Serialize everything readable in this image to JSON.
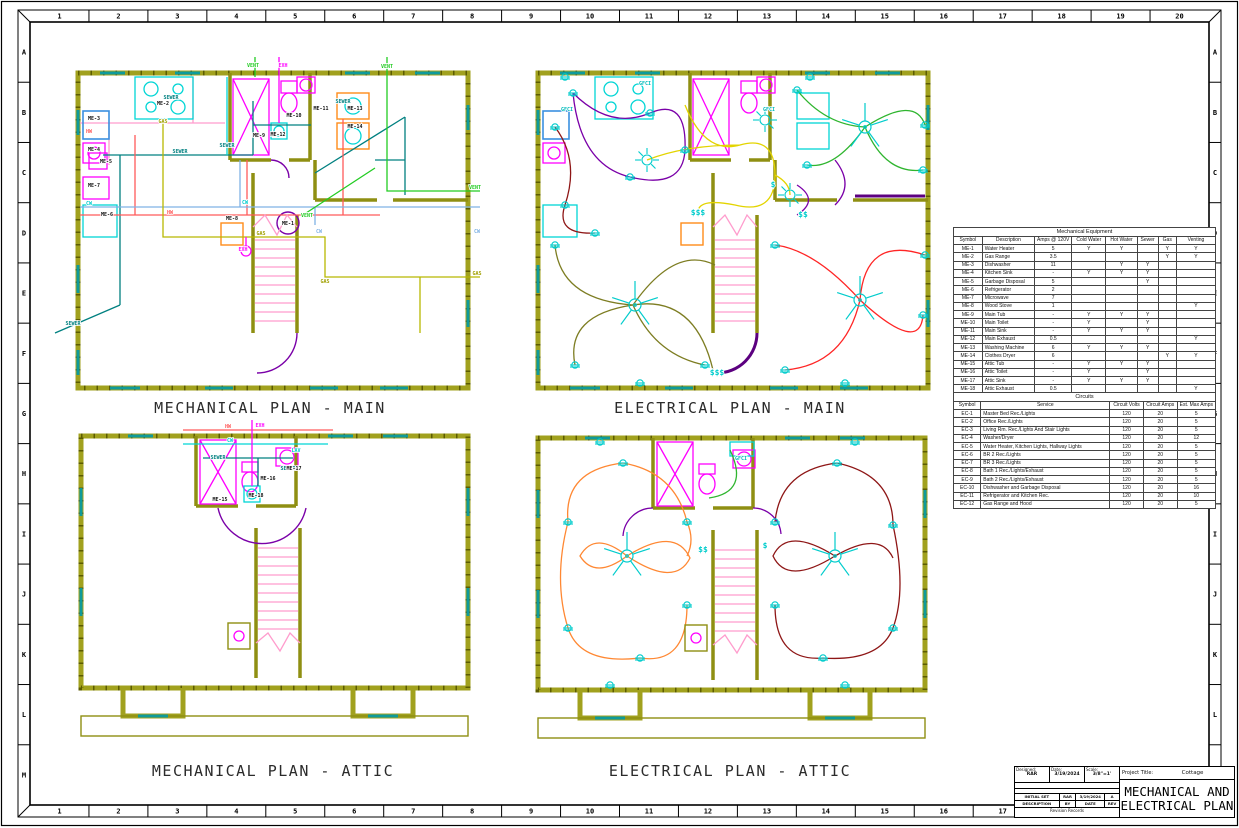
{
  "sheet": {
    "columns": [
      "1",
      "2",
      "3",
      "4",
      "5",
      "6",
      "7",
      "8",
      "9",
      "10",
      "11",
      "12",
      "13",
      "14",
      "15",
      "16",
      "17",
      "18",
      "19",
      "20"
    ],
    "rows": [
      "A",
      "B",
      "C",
      "D",
      "E",
      "F",
      "G",
      "H",
      "I",
      "J",
      "K",
      "L",
      "M"
    ]
  },
  "colors": {
    "wall": "#a1a11e",
    "sewer": "#008080",
    "hot_water": "#ff5a5a",
    "cold_water": "#7fb2e5",
    "gas": "#b8b800",
    "vent": "#22cc22",
    "exhaust": "#ff00ff",
    "fixture_magenta": "#ff00ff",
    "fixture_cyan": "#00d5d5",
    "circuit_yellow": "#e3d400",
    "circuit_red": "#ff2525",
    "circuit_green": "#2fb52f",
    "circuit_orange": "#ff8833",
    "circuit_dark_red": "#8e1616",
    "circuit_olive": "#7d7d22",
    "circuit_purple": "#7a00a8"
  },
  "plans": {
    "mech_main": {
      "title": "MECHANICAL PLAN - MAIN",
      "labels": [
        {
          "t": "VENT",
          "x": 178,
          "y": 2,
          "c": "#22cc22"
        },
        {
          "t": "EXH",
          "x": 208,
          "y": 2,
          "c": "#ff00ff"
        },
        {
          "t": "VENT",
          "x": 312,
          "y": 3,
          "c": "#22cc22"
        },
        {
          "t": "SEWER",
          "x": 96,
          "y": 34,
          "c": "#008080"
        },
        {
          "t": "SEWER",
          "x": 268,
          "y": 38,
          "c": "#008080"
        },
        {
          "t": "ME-2",
          "x": 88,
          "y": 40,
          "c": "#111111"
        },
        {
          "t": "GAS",
          "x": 88,
          "y": 58,
          "c": "#a0a000"
        },
        {
          "t": "ME-3",
          "x": 19,
          "y": 55,
          "c": "#111111"
        },
        {
          "t": "HW",
          "x": 14,
          "y": 68,
          "c": "#ff5a5a"
        },
        {
          "t": "ME-9",
          "x": 184,
          "y": 72,
          "c": "#111111"
        },
        {
          "t": "ME-10",
          "x": 219,
          "y": 52,
          "c": "#111111"
        },
        {
          "t": "ME-11",
          "x": 246,
          "y": 45,
          "c": "#111111"
        },
        {
          "t": "ME-12",
          "x": 203,
          "y": 71,
          "c": "#111111"
        },
        {
          "t": "ME-13",
          "x": 280,
          "y": 45,
          "c": "#111111"
        },
        {
          "t": "ME-14",
          "x": 280,
          "y": 63,
          "c": "#111111"
        },
        {
          "t": "ME-4",
          "x": 19,
          "y": 86,
          "c": "#111111"
        },
        {
          "t": "ME-5",
          "x": 31,
          "y": 98,
          "c": "#111111"
        },
        {
          "t": "SEWER",
          "x": 105,
          "y": 88,
          "c": "#008080"
        },
        {
          "t": "SEWER",
          "x": 152,
          "y": 82,
          "c": "#008080"
        },
        {
          "t": "ME-7",
          "x": 19,
          "y": 122,
          "c": "#111111"
        },
        {
          "t": "CW",
          "x": 14,
          "y": 140,
          "c": "#00cccc"
        },
        {
          "t": "ME-6",
          "x": 32,
          "y": 151,
          "c": "#111111"
        },
        {
          "t": "HW",
          "x": 95,
          "y": 149,
          "c": "#ff5a5a"
        },
        {
          "t": "ME-8",
          "x": 157,
          "y": 155,
          "c": "#111111"
        },
        {
          "t": "ME-1",
          "x": 213,
          "y": 160,
          "c": "#111111"
        },
        {
          "t": "CW",
          "x": 170,
          "y": 139,
          "c": "#00cccc"
        },
        {
          "t": "VENT",
          "x": 232,
          "y": 152,
          "c": "#22cc22"
        },
        {
          "t": "GAS",
          "x": 186,
          "y": 170,
          "c": "#a0a000"
        },
        {
          "t": "EXH",
          "x": 168,
          "y": 186,
          "c": "#ff00ff"
        },
        {
          "t": "CW",
          "x": 244,
          "y": 168,
          "c": "#7fb2e5"
        },
        {
          "t": "VENT",
          "x": 400,
          "y": 124,
          "c": "#22cc22"
        },
        {
          "t": "CW",
          "x": 402,
          "y": 168,
          "c": "#7fb2e5"
        },
        {
          "t": "GAS",
          "x": 402,
          "y": 210,
          "c": "#a0a000"
        },
        {
          "t": "GAS",
          "x": 250,
          "y": 218,
          "c": "#a0a000"
        },
        {
          "t": "SEWER",
          "x": -2,
          "y": 260,
          "c": "#008080"
        }
      ]
    },
    "elec_main": {
      "title": "ELECTRICAL PLAN - MAIN",
      "labels": [
        {
          "t": "GFCI",
          "x": 32,
          "y": 46,
          "c": "#00bbbb"
        },
        {
          "t": "GFCI",
          "x": 110,
          "y": 20,
          "c": "#00bbbb"
        },
        {
          "t": "GFCI",
          "x": 234,
          "y": 46,
          "c": "#00bbbb"
        },
        {
          "t": "$$$",
          "x": 163,
          "y": 150,
          "c": "#00cccc",
          "s": 8
        },
        {
          "t": "$$$",
          "x": 182,
          "y": 310,
          "c": "#00cccc",
          "s": 8
        },
        {
          "t": "$$",
          "x": 268,
          "y": 152,
          "c": "#00cccc",
          "s": 8
        },
        {
          "t": "$",
          "x": 238,
          "y": 122,
          "c": "#00cccc",
          "s": 8
        }
      ]
    },
    "mech_attic": {
      "title": "MECHANICAL PLAN - ATTIC",
      "labels": [
        {
          "t": "EXH",
          "x": 182,
          "y": -1,
          "c": "#ff00ff"
        },
        {
          "t": "HW",
          "x": 150,
          "y": 0,
          "c": "#ff5a5a"
        },
        {
          "t": "CW",
          "x": 152,
          "y": 14,
          "c": "#00cccc"
        },
        {
          "t": "SEWER",
          "x": 140,
          "y": 31,
          "c": "#008080"
        },
        {
          "t": "SEWER",
          "x": 210,
          "y": 42,
          "c": "#008080"
        },
        {
          "t": "LAV",
          "x": 218,
          "y": 24,
          "c": "#00cccc"
        },
        {
          "t": "ME-17",
          "x": 216,
          "y": 42,
          "c": "#111111"
        },
        {
          "t": "ME-16",
          "x": 190,
          "y": 52,
          "c": "#111111"
        },
        {
          "t": "ME-18",
          "x": 178,
          "y": 69,
          "c": "#111111"
        },
        {
          "t": "ME-15",
          "x": 142,
          "y": 73,
          "c": "#111111"
        }
      ]
    },
    "elec_attic": {
      "title": "ELECTRICAL PLAN - ATTIC",
      "labels": [
        {
          "t": "GFCI",
          "x": 206,
          "y": 30,
          "c": "#00bbbb"
        },
        {
          "t": "$$",
          "x": 168,
          "y": 122,
          "c": "#00cccc",
          "s": 8
        },
        {
          "t": "$",
          "x": 230,
          "y": 118,
          "c": "#00cccc",
          "s": 8
        }
      ]
    }
  },
  "mech_table": {
    "title": "Mechanical Equipment",
    "columns": [
      "Symbol",
      "Description",
      "Amps @ 120V",
      "Cold Water",
      "Hot Water",
      "Sewer",
      "Gas",
      "Venting"
    ],
    "widths": [
      11,
      20,
      14,
      13,
      12,
      8,
      7,
      15
    ],
    "rows": [
      [
        "ME-1",
        "Water Heater",
        "5",
        "Y",
        "Y",
        "",
        "Y",
        "Y"
      ],
      [
        "ME-2",
        "Gas Range",
        "3.5",
        "",
        "",
        "",
        "Y",
        "Y"
      ],
      [
        "ME-3",
        "Dishwasher",
        "11",
        "",
        "Y",
        "Y",
        "",
        ""
      ],
      [
        "ME-4",
        "Kitchen Sink",
        "-",
        "Y",
        "Y",
        "Y",
        "",
        ""
      ],
      [
        "ME-5",
        "Garbage Disposal",
        "5",
        "",
        "",
        "Y",
        "",
        ""
      ],
      [
        "ME-6",
        "Refrigerator",
        "2",
        "",
        "",
        "",
        "",
        ""
      ],
      [
        "ME-7",
        "Microwave",
        "7",
        "",
        "",
        "",
        "",
        ""
      ],
      [
        "ME-8",
        "Wood Stove",
        "1",
        "",
        "",
        "",
        "",
        "Y"
      ],
      [
        "ME-9",
        "Main Tub",
        "-",
        "Y",
        "Y",
        "Y",
        "",
        ""
      ],
      [
        "ME-10",
        "Main Toilet",
        "-",
        "Y",
        "",
        "Y",
        "",
        ""
      ],
      [
        "ME-11",
        "Main Sink",
        "-",
        "Y",
        "Y",
        "Y",
        "",
        ""
      ],
      [
        "ME-12",
        "Main Exhaust",
        "0.5",
        "",
        "",
        "",
        "",
        "Y"
      ],
      [
        "ME-13",
        "Washing Machine",
        "6",
        "Y",
        "Y",
        "Y",
        "",
        ""
      ],
      [
        "ME-14",
        "Clothes Dryer",
        "6",
        "",
        "",
        "",
        "Y",
        "Y"
      ],
      [
        "ME-15",
        "Attic Tub",
        "-",
        "Y",
        "Y",
        "Y",
        "",
        ""
      ],
      [
        "ME-16",
        "Attic Toilet",
        "-",
        "Y",
        "",
        "Y",
        "",
        ""
      ],
      [
        "ME-17",
        "Attic Sink",
        "-",
        "Y",
        "Y",
        "Y",
        "",
        ""
      ],
      [
        "ME-18",
        "Attic Exhaust",
        "0.5",
        "",
        "",
        "",
        "",
        "Y"
      ]
    ]
  },
  "circuits_table": {
    "title": "Circuits",
    "columns": [
      "Symbol",
      "Service",
      "Circuit Volts",
      "Circuit Amps",
      "Est. Max Amps"
    ],
    "widths": [
      11,
      52,
      13,
      13,
      11
    ],
    "rows": [
      [
        "EC-1",
        "Master Bed Rec./Lights",
        "120",
        "20",
        "5"
      ],
      [
        "EC-2",
        "Office Rec./Lights",
        "120",
        "20",
        "5"
      ],
      [
        "EC-3",
        "Living Rm. Rec./Lights And Stair Lights",
        "120",
        "20",
        "5"
      ],
      [
        "EC-4",
        "Washer/Dryer",
        "120",
        "20",
        "12"
      ],
      [
        "EC-5",
        "Water Heater, Kitchen Lights, Hallway Lights",
        "120",
        "20",
        "5"
      ],
      [
        "EC-6",
        "BR 2 Rec./Lights",
        "120",
        "20",
        "5"
      ],
      [
        "EC-7",
        "BR 3 Rec./Lights",
        "120",
        "20",
        "5"
      ],
      [
        "EC-8",
        "Bath 1 Rec./Lights/Exhaust",
        "120",
        "20",
        "5"
      ],
      [
        "EC-9",
        "Bath 2 Rec./Lights/Exhaust",
        "120",
        "20",
        "5"
      ],
      [
        "EC-10",
        "Dishwasher and Garbage Disposal",
        "120",
        "20",
        "16"
      ],
      [
        "EC-11",
        "Refrigerator and Kitchen Rec.",
        "120",
        "20",
        "10"
      ],
      [
        "EC-12",
        "Gas Range and Hood",
        "120",
        "20",
        "5"
      ]
    ]
  },
  "title_block": {
    "designed_label": "Designed:",
    "designed": "RAR",
    "date_label": "Date:",
    "date": "3/19/2024",
    "scale_label": "Scale:",
    "scale": "3/8\"=1'",
    "revision_entry": {
      "description": "INITIAL SET",
      "by": "RAR",
      "date": "3/19/2024",
      "rev": "A"
    },
    "revision_headers": {
      "description": "DESCRIPTION",
      "by": "BY",
      "date": "DATE",
      "rev": "REV"
    },
    "revision_records_label": "Revision Records",
    "project_title_label": "Project Title:",
    "project_title": "Cottage",
    "sheet_title_line1": "MECHANICAL AND",
    "sheet_title_line2": "ELECTRICAL PLAN"
  }
}
